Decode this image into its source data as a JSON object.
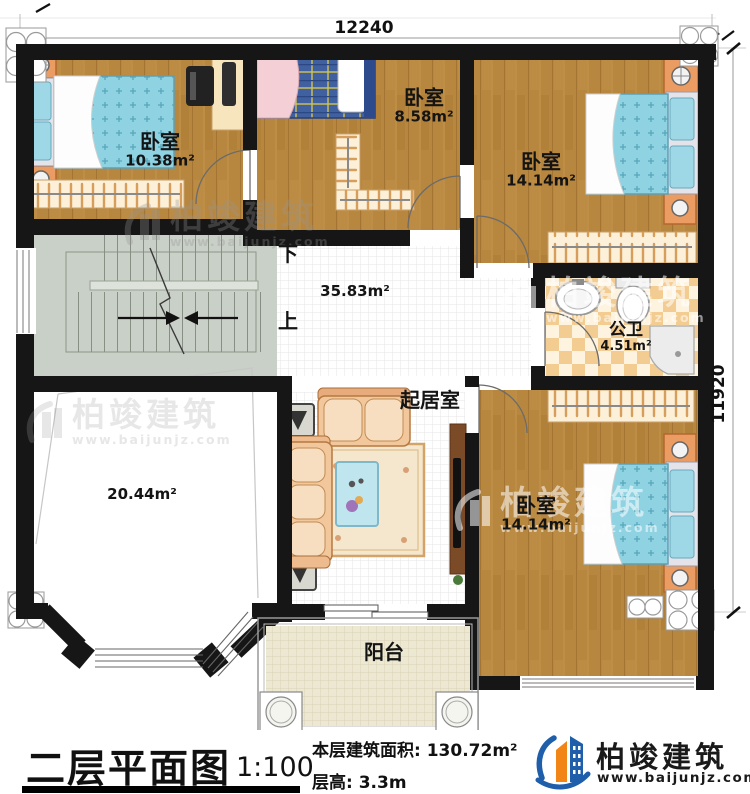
{
  "dimensions": {
    "top": "12240",
    "right": "11920"
  },
  "rooms": {
    "bedroom_top_left": {
      "name": "卧室",
      "area": "10.38m²"
    },
    "bedroom_top_middle": {
      "name": "卧室",
      "area": "8.58m²"
    },
    "bedroom_top_right": {
      "name": "卧室",
      "area": "14.14m²"
    },
    "bathroom": {
      "name": "公卫",
      "area": "4.51m²"
    },
    "hall": {
      "area": "35.83m²"
    },
    "living_room": {
      "name": "起居室"
    },
    "open_space": {
      "area": "20.44m²"
    },
    "bedroom_bottom_right": {
      "name": "卧室",
      "area": "14.14m²"
    },
    "balcony": {
      "name": "阳台"
    }
  },
  "stairs": {
    "down_label": "下",
    "up_label": "上"
  },
  "title_block": {
    "title": "二层平面图",
    "scale": "1:100",
    "floor_area_label": "本层建筑面积: 130.72m²",
    "floor_height_label": "层高: 3.3m"
  },
  "brand": {
    "name": "柏竣建筑",
    "website": "www.baijunjz.com"
  },
  "watermark": {
    "name": "柏竣建筑",
    "website": "www.baijunjz.com"
  },
  "colors": {
    "wall": "#161616",
    "wood": "#b8873f",
    "bed_blue": "#8fd2e2",
    "plaid_blue": "#40609f",
    "stair": "#c9d0c7",
    "tile_checker": "#f3cc92",
    "balcony": "#ece8d2",
    "sofa": "#f2c79b",
    "logo_blue": "#1e5eaa",
    "logo_orange": "#f18616"
  }
}
